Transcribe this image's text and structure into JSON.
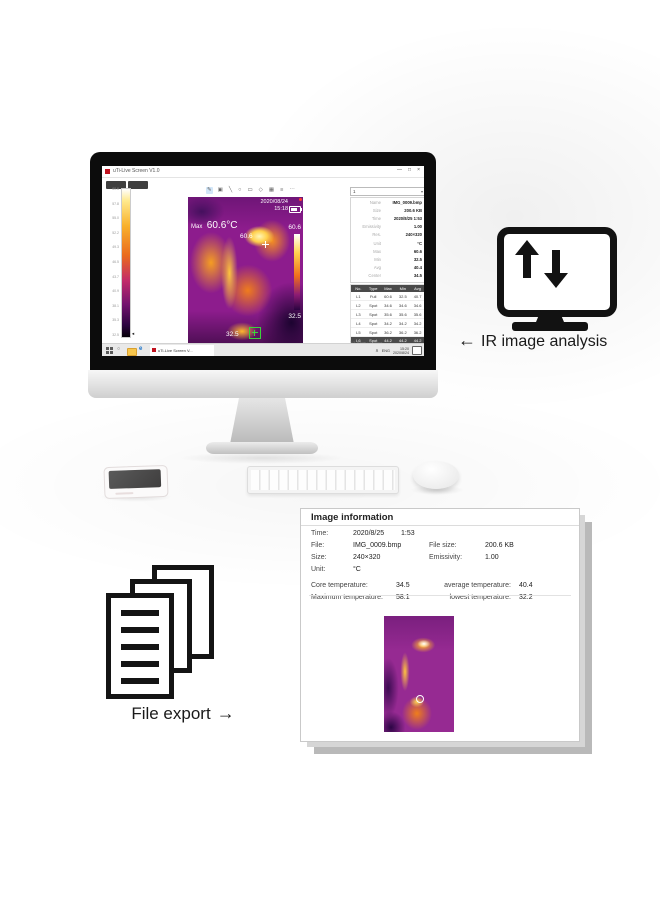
{
  "annotations": {
    "ir": {
      "arrow": "←",
      "label": "IR image analysis"
    },
    "export": {
      "label": "File export",
      "arrow": "→"
    }
  },
  "app": {
    "window": {
      "title": "uTi-Live Screen V1.0",
      "controls": [
        "—",
        "□",
        "×"
      ]
    },
    "toolbar": {
      "icons": [
        "✎",
        "▣",
        "╲",
        "○",
        "▭",
        "◇",
        "▦",
        "≡",
        "⋯"
      ]
    },
    "scale": {
      "ticks": [
        "60.6",
        "57.8",
        "55.0",
        "52.2",
        "49.3",
        "46.5",
        "43.7",
        "40.9",
        "38.1",
        "35.3",
        "32.5"
      ],
      "speaker_icon": "◄"
    },
    "thermal": {
      "date": "2020/08/24",
      "time": "15:18",
      "max_label": "Max",
      "max_value": "60.6°C",
      "spot_value": "60.6",
      "bar_max": "60.6",
      "bar_min": "32.5",
      "center_value": "32.5"
    },
    "side_panel": {
      "select_value": "1",
      "select_arrow": "▾",
      "rows": [
        {
          "label": "Name",
          "value": "IMG_0009.bmp"
        },
        {
          "label": "Size",
          "value": "200.6 KB"
        },
        {
          "label": "Time",
          "value": "2020/8/25 1:53"
        },
        {
          "label": "Emissivity",
          "value": "1.00"
        },
        {
          "label": "Res.",
          "value": "240×320"
        },
        {
          "label": "Unit",
          "value": "°C"
        },
        {
          "label": "Max",
          "value": "60.6"
        },
        {
          "label": "Min",
          "value": "32.5"
        },
        {
          "label": "Avg",
          "value": "40.4"
        },
        {
          "label": "Center",
          "value": "34.5"
        }
      ]
    },
    "table": {
      "headers": [
        "No.",
        "Type",
        "Max",
        "Min",
        "Avg"
      ],
      "rows": [
        [
          "L1",
          "Full",
          "60.6",
          "32.5",
          "40.7"
        ],
        [
          "L2",
          "Spot",
          "34.6",
          "34.6",
          "34.6"
        ],
        [
          "L3",
          "Spot",
          "35.6",
          "35.6",
          "35.6"
        ],
        [
          "L4",
          "Spot",
          "34.2",
          "34.2",
          "34.2"
        ],
        [
          "L5",
          "Spot",
          "36.2",
          "36.2",
          "36.2"
        ]
      ],
      "footer": [
        "L6",
        "Spot",
        "44.2",
        "44.2",
        "44.2"
      ],
      "pagination": "1/1 Page · 6 items"
    },
    "taskbar": {
      "search_icon": "○",
      "edge_icon": "e",
      "app_button": "uTi-Live Screen V...",
      "tray_caret": "∧",
      "tray_lang": "ENG",
      "time": "15:20",
      "date": "2020/8/24"
    }
  },
  "info_panel": {
    "title": "Image information",
    "fields": {
      "time": {
        "label": "Time:",
        "value": "2020/8/25",
        "extra": "1:53"
      },
      "file": {
        "label": "File:",
        "value": "IMG_0009.bmp"
      },
      "filesize": {
        "label": "File size:",
        "value": "200.6 KB"
      },
      "size": {
        "label": "Size:",
        "value": "240×320"
      },
      "emissivity": {
        "label": "Emissivity:",
        "value": "1.00"
      },
      "unit": {
        "label": "Unit:",
        "value": "°C"
      }
    },
    "temps": {
      "core": {
        "label": "Core temperature:",
        "value": "34.5"
      },
      "avg": {
        "label": "average temperature:",
        "value": "40.4"
      },
      "max": {
        "label": "Maximum temperature:",
        "value": "58.1"
      },
      "low": {
        "label": "lowest temperature:",
        "value": "32.2"
      }
    }
  },
  "colors": {
    "brand_red": "#c1121f",
    "palette_hot": "#fff7c0",
    "palette_mid": "#e85d1a",
    "palette_cold": "#120220",
    "thermal_base": "#8d1c8d"
  }
}
